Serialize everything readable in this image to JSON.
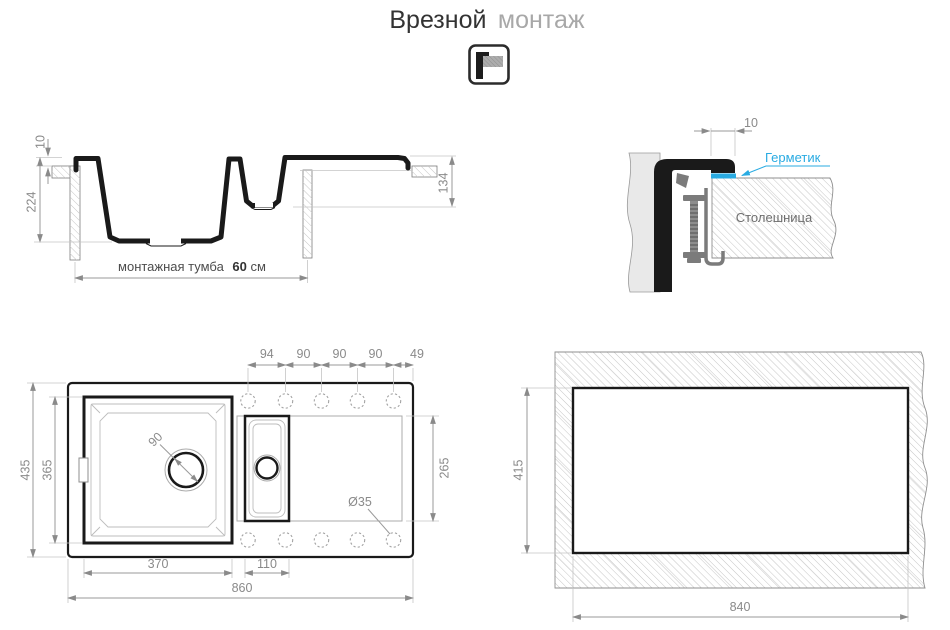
{
  "title": {
    "main": "Врезной",
    "sub": "монтаж"
  },
  "icon": {
    "name": "flush-mount-icon"
  },
  "colors": {
    "outline": "#1a1a1a",
    "dim_line": "#9a9a9a",
    "dim_text": "#8a8a8a",
    "dark_text": "#4d4d4d",
    "accent_cyan": "#29abe2",
    "sink_body_fill": "#e9e9e9",
    "clamp_gray": "#7b7b7b"
  },
  "side_section": {
    "rim_height": "10",
    "bowl_depth": "224",
    "right_depth": "134",
    "cabinet_prefix": "монтажная тумба",
    "cabinet_value": "60",
    "cabinet_unit": "см"
  },
  "edge_detail": {
    "overhang": "10",
    "sealant_label": "Герметик",
    "countertop_label": "Столешница"
  },
  "top_view": {
    "hole_spacing": [
      "94",
      "90",
      "90",
      "90",
      "49"
    ],
    "overall_depth": "435",
    "bowl_inner_depth": "365",
    "drain_diameter": "90",
    "drainer_depth": "265",
    "hole_diameter": "Ø35",
    "bowl_width": "370",
    "small_bowl_width": "110",
    "overall_width": "860"
  },
  "cutout": {
    "depth": "415",
    "width": "840"
  }
}
